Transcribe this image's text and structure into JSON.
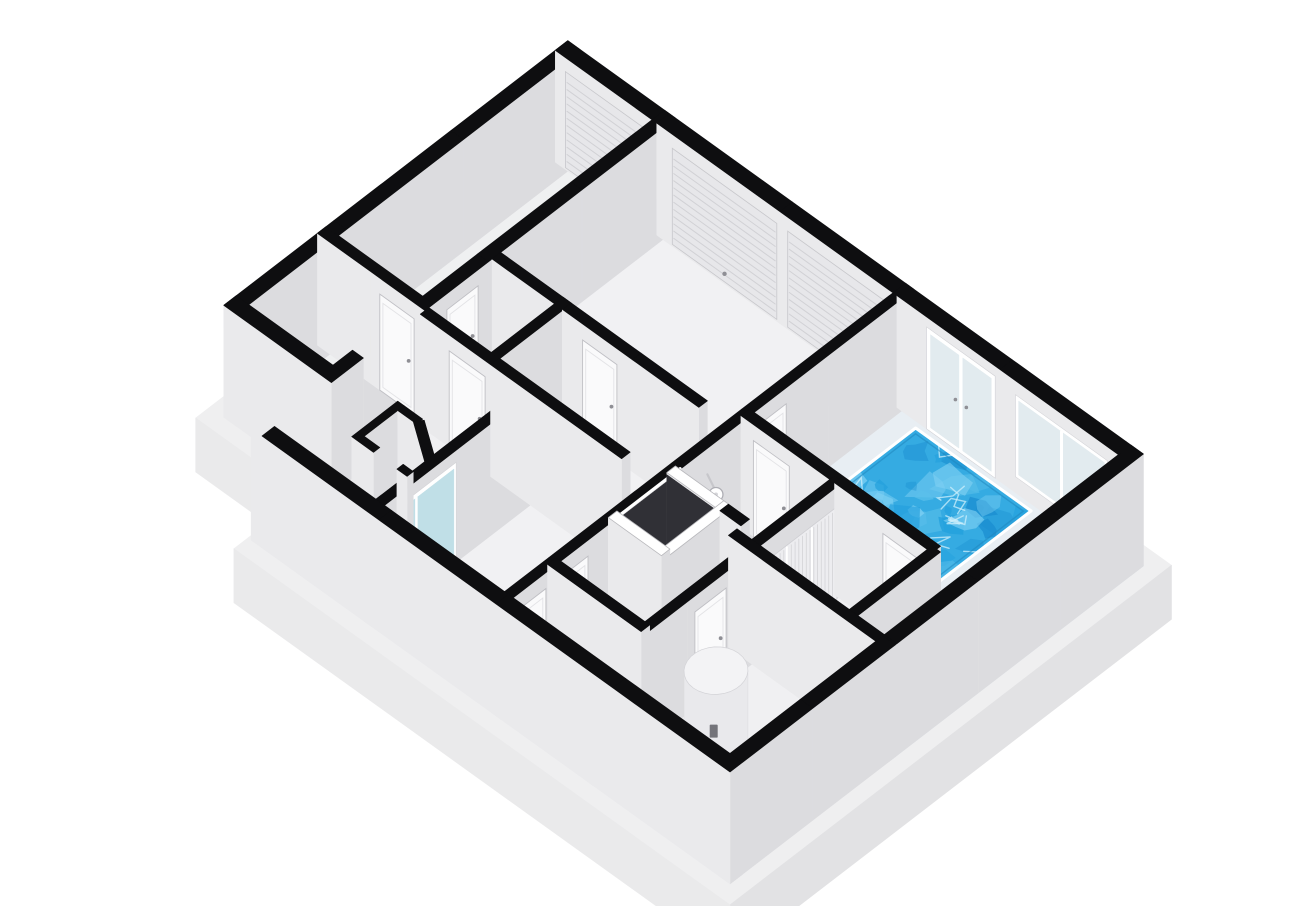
{
  "scene": {
    "background": "#ffffff",
    "canvas": {
      "width": 1300,
      "height": 890
    }
  },
  "projection": {
    "origin_x": 222,
    "origin_y": 532,
    "k": 0.78,
    "cx": 0.6,
    "cy": 0.56,
    "wall_height": 112,
    "slab_depth": 54
  },
  "colors": {
    "wallTop": "#0e0e10",
    "whiteTop": "#ffffff",
    "south": "#dcdcdf",
    "west": "#eaeaec",
    "floor": "#f0f0f2",
    "floorAlt": "#f1f1f3",
    "wing": "#eff0f1",
    "deck": "#e8eef3",
    "darkFloor": "#2e2e32",
    "darkFace": "#303036",
    "slabTop": "#efeff0",
    "slabWest": "#eaeaeb",
    "slabSouth": "#e2e2e4",
    "water": "#35abe2",
    "waterDeep": "#1b8ed0",
    "waterLight": "#7ed0f3",
    "waterPale": "#cdeffb",
    "coping": "#ffffff",
    "poolEdge": "#1f87bd",
    "frame": "#ffffff",
    "glass": "#e2ebef",
    "teal": "#c0dfe7",
    "leaf": "#fafafb",
    "leafStroke": "#bfbfc4",
    "handle": "#8f8f95",
    "roller": "#e7e7ea",
    "rollerLine": "#d1d1d5",
    "stripePanel": "#ededf0",
    "stripeLine": "#d6d6d9",
    "boxTop": "#f6f6f8",
    "boxSouth": "#e9e9ec",
    "boxWest": "#f1f1f3",
    "boxStroke": "#d8d8db",
    "heaterSide": "#e9e9ec",
    "heaterTop": "#f3f3f5",
    "heaterLabel": "#74747a",
    "knob": "#46464c"
  },
  "plan": {
    "slab_outline": [
      [
        -18,
        -18
      ],
      [
        71,
        -18
      ],
      [
        71,
        -156
      ],
      [
        548,
        -156
      ],
      [
        548,
        618
      ],
      [
        -18,
        618
      ]
    ],
    "rooms": [
      {
        "id": "wing-storage",
        "fill": "wing",
        "poly": [
          [
            89,
            -138
          ],
          [
            215,
            -138
          ],
          [
            215,
            0
          ],
          [
            89,
            0
          ]
        ]
      },
      {
        "id": "wing-garage",
        "fill": "wing",
        "poly": [
          [
            215,
            -138
          ],
          [
            530,
            -138
          ],
          [
            530,
            0
          ],
          [
            215,
            0
          ]
        ]
      },
      {
        "id": "workshop",
        "fill": "floorAlt",
        "poly": [
          [
            300,
            0
          ],
          [
            530,
            0
          ],
          [
            530,
            300
          ],
          [
            300,
            300
          ]
        ]
      },
      {
        "id": "storeroom",
        "fill": "floor",
        "poly": [
          [
            208,
            0
          ],
          [
            300,
            0
          ],
          [
            300,
            85
          ],
          [
            208,
            85
          ]
        ]
      },
      {
        "id": "west-room",
        "fill": "floor",
        "poly": [
          [
            0,
            0
          ],
          [
            208,
            0
          ],
          [
            208,
            135
          ],
          [
            0,
            135
          ]
        ]
      },
      {
        "id": "hallway",
        "fill": "floorAlt",
        "poly": [
          [
            0,
            135
          ],
          [
            300,
            135
          ],
          [
            300,
            300
          ],
          [
            0,
            300
          ]
        ]
      },
      {
        "id": "wc-a",
        "fill": "floor",
        "poly": [
          [
            0,
            300
          ],
          [
            72,
            300
          ],
          [
            72,
            420
          ],
          [
            0,
            420
          ]
        ]
      },
      {
        "id": "wc-b",
        "fill": "floor",
        "poly": [
          [
            72,
            300
          ],
          [
            150,
            300
          ],
          [
            150,
            420
          ],
          [
            72,
            420
          ]
        ]
      },
      {
        "id": "dark-room",
        "fill": "darkFloor",
        "poly": [
          [
            144,
            295
          ],
          [
            230,
            295
          ],
          [
            230,
            373
          ],
          [
            144,
            373
          ]
        ]
      },
      {
        "id": "shower-room",
        "fill": "floor",
        "poly": [
          [
            225,
            300
          ],
          [
            320,
            300
          ],
          [
            320,
            395
          ],
          [
            225,
            395
          ]
        ]
      },
      {
        "id": "corridor",
        "fill": "floor",
        "poly": [
          [
            150,
            368
          ],
          [
            225,
            368
          ],
          [
            225,
            395
          ],
          [
            320,
            395
          ],
          [
            320,
            420
          ],
          [
            150,
            420
          ]
        ]
      },
      {
        "id": "utility-room",
        "fill": "floor",
        "poly": [
          [
            0,
            420
          ],
          [
            208,
            420
          ],
          [
            208,
            600
          ],
          [
            0,
            600
          ]
        ]
      },
      {
        "id": "changing-room",
        "fill": "floor",
        "poly": [
          [
            208,
            420
          ],
          [
            320,
            420
          ],
          [
            320,
            545
          ],
          [
            208,
            545
          ]
        ]
      },
      {
        "id": "pool-hall",
        "fill": "deck",
        "poly": [
          [
            320,
            300
          ],
          [
            530,
            300
          ],
          [
            530,
            600
          ],
          [
            208,
            600
          ],
          [
            208,
            545
          ],
          [
            320,
            545
          ]
        ]
      }
    ],
    "pool": {
      "x0": 335,
      "x1": 508,
      "y0": 330,
      "y1": 478,
      "blob_count": 52,
      "squiggle_count": 16,
      "seed": 11
    },
    "walls": [
      {
        "id": "wing-nw",
        "rect": [
          89,
          530,
          -138,
          -122
        ],
        "splits": [
          230,
          380
        ]
      },
      {
        "id": "wing-west-end",
        "rect": [
          89,
          105,
          -138,
          0
        ]
      },
      {
        "id": "wing-divider",
        "rect": [
          209,
          220,
          -138,
          0
        ],
        "splits": [
          -70
        ],
        "decals": [
          {
            "kind": "leaf",
            "u0": -58,
            "u1": -14,
            "z0": 0,
            "z1": 96
          }
        ]
      },
      {
        "id": "exterior-ne",
        "rect": [
          514,
          530,
          -138,
          600
        ],
        "splits": [
          -8,
          150,
          300,
          432,
          578
        ],
        "decals": [
          {
            "kind": "roller",
            "u0": -125,
            "u1": -18,
            "z0": 2,
            "z1": 98
          },
          {
            "kind": "roller",
            "u0": 12,
            "u1": 146,
            "z0": 2,
            "z1": 98
          },
          {
            "kind": "roller",
            "u0": 160,
            "u1": 294,
            "z0": 2,
            "z1": 98
          },
          {
            "kind": "frdoor",
            "u0": 338,
            "u1": 426,
            "z0": 0,
            "z1": 102
          },
          {
            "kind": "window",
            "u0": 452,
            "u1": 570,
            "z0": 16,
            "z1": 98
          }
        ]
      },
      {
        "id": "main-nw",
        "rect": [
          0,
          530,
          -14,
          0
        ],
        "splits": [
          130,
          290,
          410
        ],
        "decals": [
          {
            "kind": "leaf",
            "u0": 237,
            "u1": 277,
            "z0": 0,
            "z1": 96
          }
        ]
      },
      {
        "id": "exterior-sw",
        "rect": [
          0,
          16,
          0,
          600
        ],
        "splits": [
          150,
          300,
          450
        ]
      },
      {
        "id": "exterior-se",
        "rect": [
          0,
          530,
          584,
          600
        ],
        "splits": [
          106,
          212,
          318,
          424
        ]
      },
      {
        "id": "v2-westzone",
        "rect": [
          203,
          214,
          0,
          258
        ],
        "splits": [
          90,
          180
        ],
        "decals": [
          {
            "kind": "leaf",
            "u0": 37,
            "u1": 83,
            "z0": 0,
            "z1": 96
          }
        ]
      },
      {
        "id": "v1-workshop",
        "rect": [
          295,
          306,
          0,
          265
        ],
        "splits": [
          90,
          180
        ],
        "decals": [
          {
            "kind": "leaf",
            "u0": 116,
            "u1": 160,
            "z0": 0,
            "z1": 96
          }
        ]
      },
      {
        "id": "h2-storeroom",
        "rect": [
          203,
          306,
          80,
          91
        ]
      },
      {
        "id": "h3-westroom",
        "rect": [
          0,
          208,
          130,
          141
        ],
        "splits": [
          110
        ],
        "decals": [
          {
            "kind": "glassdoor",
            "u0": 42,
            "u1": 108,
            "z0": 0,
            "z1": 100
          }
        ]
      },
      {
        "id": "w4-spine",
        "rect": [
          0,
          530,
          295,
          306
        ],
        "splits": [
          72,
          144,
          230,
          320,
          420
        ],
        "decals": [
          {
            "kind": "leaf",
            "u0": 22,
            "u1": 58,
            "z0": 0,
            "z1": 96
          },
          {
            "kind": "leaf",
            "u0": 76,
            "u1": 112,
            "z0": 0,
            "z1": 96
          },
          {
            "kind": "darkpatch",
            "u0": 150,
            "u1": 224,
            "z0": 0,
            "z1": 110
          },
          {
            "kind": "rim",
            "u0": 144,
            "u1": 230
          },
          {
            "kind": "shower",
            "u0": 258,
            "u1": 272,
            "z0": 60,
            "z1": 84
          },
          {
            "kind": "leaf",
            "u0": 326,
            "u1": 366,
            "z0": 0,
            "z1": 96
          }
        ]
      },
      {
        "id": "dark-west",
        "rect": [
          144,
          155,
          300,
          368
        ],
        "top": "white"
      },
      {
        "id": "dark-east",
        "rect": [
          219,
          230,
          300,
          368
        ],
        "top": "white",
        "decals": [
          {
            "kind": "darkpatch",
            "u0": 300,
            "u1": 368,
            "z0": 0,
            "z1": 110
          }
        ]
      },
      {
        "id": "dark-south",
        "rect": [
          144,
          230,
          362,
          373
        ],
        "top": "white"
      },
      {
        "id": "v7-lower",
        "rect": [
          219,
          230,
          368,
          395
        ]
      },
      {
        "id": "w8-shower-s",
        "rect": [
          219,
          320,
          389,
          400
        ]
      },
      {
        "id": "h11-lower",
        "rect": [
          0,
          320,
          414,
          425
        ],
        "splits": [
          120,
          210
        ],
        "decals": [
          {
            "kind": "leaf",
            "u0": 130,
            "u1": 170,
            "z0": 0,
            "z1": 96
          },
          {
            "kind": "stripes",
            "u0": 216,
            "u1": 312,
            "z0": 0,
            "z1": 92
          }
        ]
      },
      {
        "id": "v8-wc-divider",
        "rect": [
          66,
          77,
          300,
          420
        ]
      },
      {
        "id": "v9-pool-west",
        "rect": [
          314,
          325,
          300,
          545
        ],
        "splits": [
          420
        ],
        "decals": [
          {
            "kind": "leaf",
            "u0": 316,
            "u1": 362,
            "z0": 0,
            "z1": 96
          },
          {
            "kind": "leaf",
            "u0": 482,
            "u1": 526,
            "z0": 0,
            "z1": 96
          }
        ]
      },
      {
        "id": "v11-utility-e",
        "rect": [
          203,
          214,
          395,
          600
        ],
        "splits": [
          500
        ]
      },
      {
        "id": "h5-changing-s",
        "rect": [
          208,
          320,
          539,
          550
        ]
      },
      {
        "id": "pod-n",
        "rect": [
          55,
          114,
          60,
          68
        ]
      },
      {
        "id": "pod-e",
        "rect": [
          106,
          114,
          68,
          92
        ]
      },
      {
        "id": "pod-w-a",
        "rect": [
          55,
          63,
          68,
          88
        ]
      },
      {
        "id": "pod-w-b",
        "rect": [
          55,
          63,
          118,
          131
        ]
      }
    ],
    "pod_diagonal": [
      [
        106,
        88
      ],
      [
        114,
        94
      ],
      [
        86,
        137
      ],
      [
        78,
        131
      ]
    ],
    "fixtures": [
      {
        "id": "washing-machine",
        "type": "box",
        "rect": [
          14,
          66,
          426,
          480
        ],
        "h": 54,
        "dots": [
          [
            26,
            438
          ],
          [
            40,
            438
          ]
        ]
      },
      {
        "id": "water-heater",
        "type": "cylinder",
        "cx": 108,
        "cy": 474,
        "r": 29,
        "h": 78
      },
      {
        "id": "toilet-tank",
        "type": "box",
        "rect": [
          80,
          114,
          310,
          342
        ],
        "h": 38
      },
      {
        "id": "toilet-bowl",
        "type": "box",
        "rect": [
          84,
          110,
          344,
          366
        ],
        "h": 22
      }
    ]
  }
}
